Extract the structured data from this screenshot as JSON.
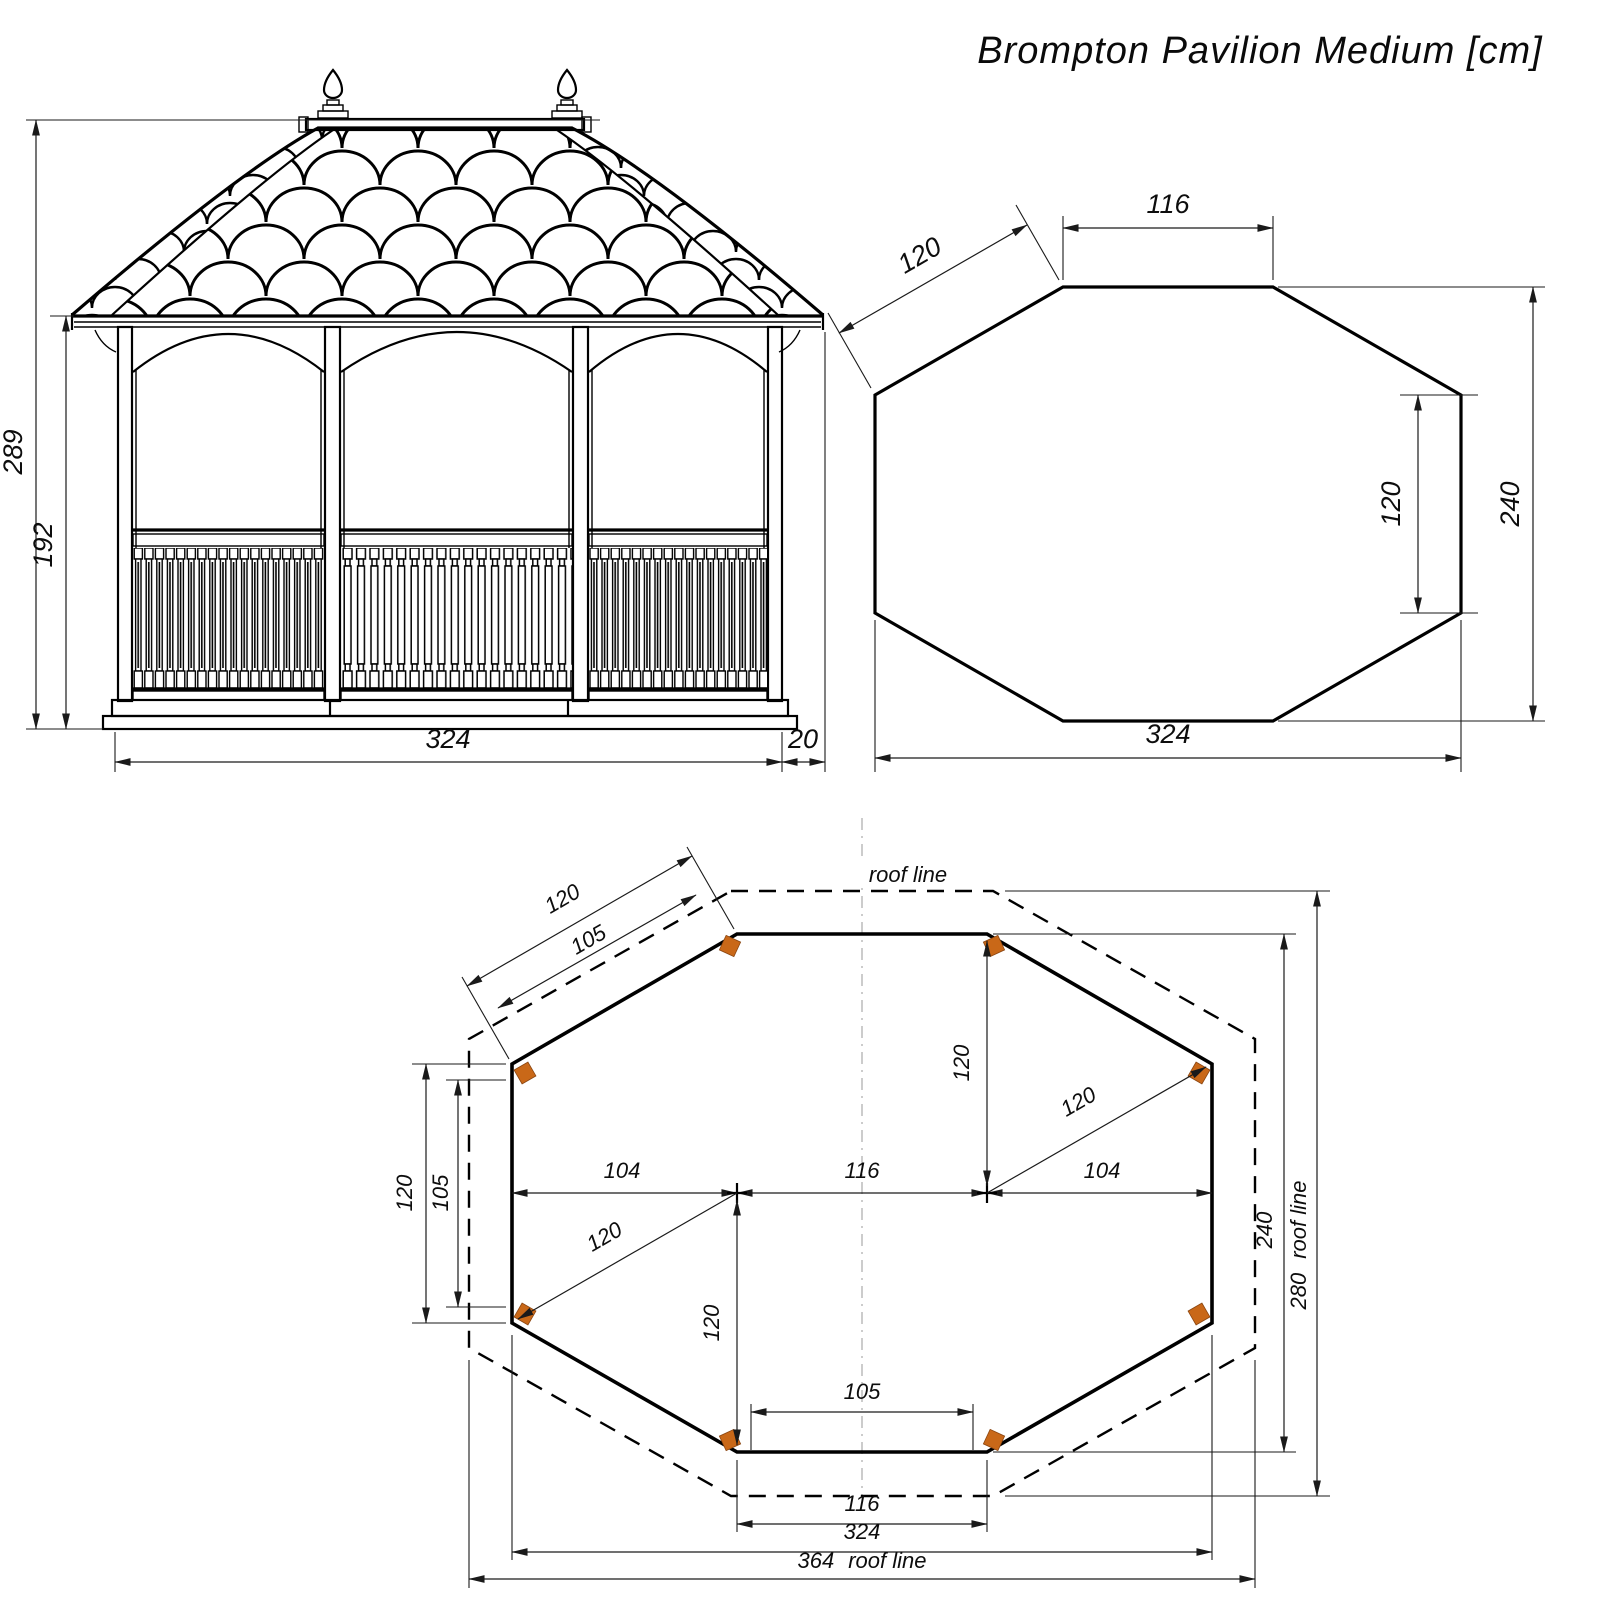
{
  "title": "Brompton Pavilion Medium [cm]",
  "colors": {
    "ink": "#000000",
    "dim_line": "#1a1a1a",
    "post_marker": "#c96818",
    "centerline": "#9a9a9a"
  },
  "elevation": {
    "overall_height": "289",
    "eave_height": "192",
    "base_width": "324",
    "roof_overhang": "20"
  },
  "roof_plan": {
    "front_edge": "116",
    "corner_edge": "120",
    "side_edge": "120",
    "depth": "240",
    "width": "324"
  },
  "floor_plan": {
    "roof_line_label": "roof line",
    "corner_outer": "120",
    "corner_inner": "105",
    "side_outer": "120",
    "side_inner": "105",
    "bay_left": "104",
    "bay_center": "116",
    "bay_right": "104",
    "radius_upper_right": "120",
    "radius_lower_left": "120",
    "column_above": "120",
    "column_below": "120",
    "post_spacing_front": "105",
    "front_edge": "116",
    "floor_width": "324",
    "roof_width": "364",
    "floor_depth": "240",
    "roof_depth": "280",
    "roof_line_right_label": "roof line",
    "roof_line_bottom_label": "roof line"
  }
}
